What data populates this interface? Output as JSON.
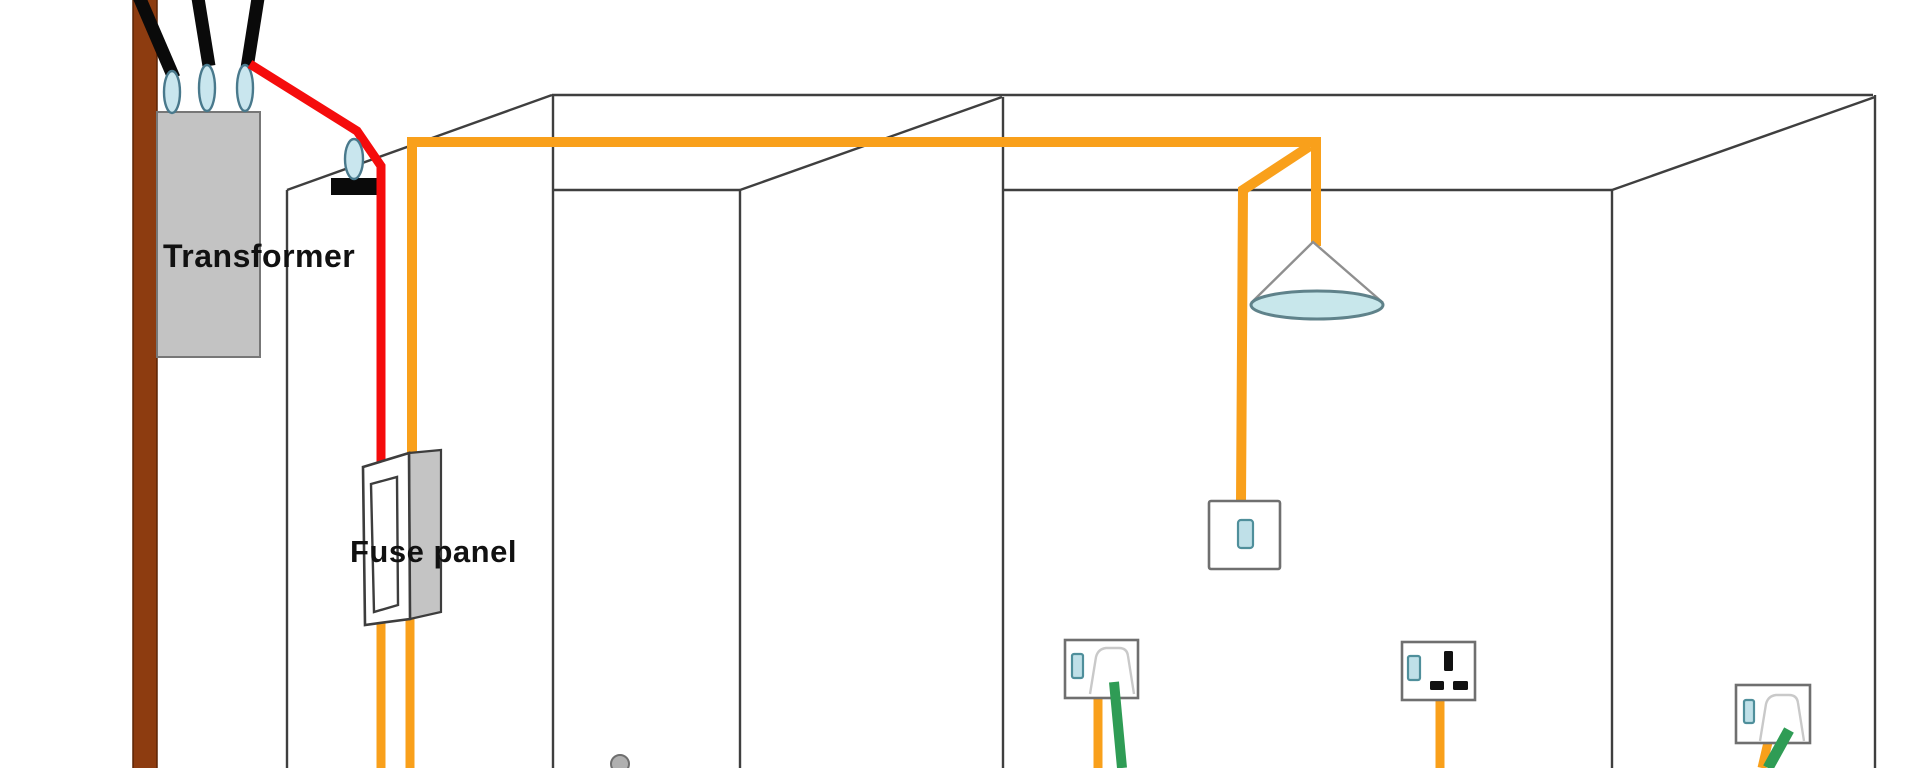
{
  "labels": {
    "transformer": "Transformer",
    "fuse_panel": "Fuse panel"
  },
  "colors": {
    "wall_line": "#3f3f3f",
    "pole_brown": "#8d3c10",
    "pole_outline": "#5c2506",
    "cable_black": "#0a0a0a",
    "supply_red": "#f50c0c",
    "live_orange": "#f9a01b",
    "cord_green": "#2f9c55",
    "insulator_blue": "#c9e6ee",
    "insulator_outline": "#49798c",
    "transformer_gray": "#c3c3c3",
    "transformer_outline": "#777777",
    "panel_side_gray": "#c4c4c4",
    "panel_outline": "#3d3d3d",
    "device_outline": "#6f6f6f",
    "toggle_blue": "#bfe0e8",
    "toggle_outline": "#4f8f9b",
    "plug_outline": "#c9c9c9",
    "slot_black": "#111111",
    "lamp_shade_blue": "#c8e7eb",
    "lamp_outline": "#8f8f8f",
    "lamp_shade_outline": "#5f828a",
    "knob_gray": "#b0b0b0",
    "knob_outline": "#6f6f6f",
    "label_color": "#111111"
  }
}
